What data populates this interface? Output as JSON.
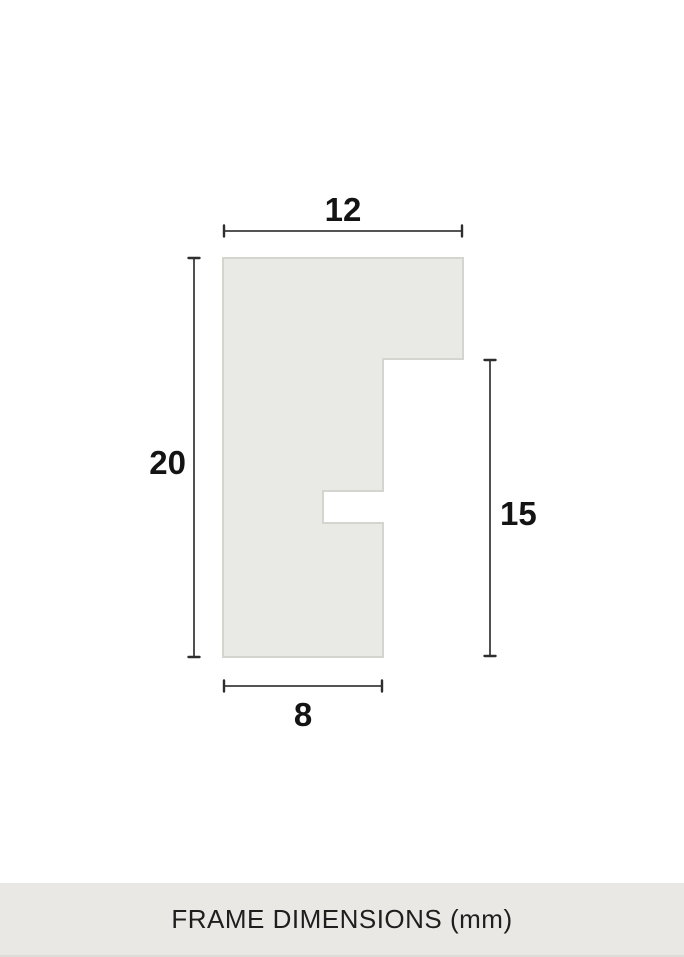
{
  "diagram": {
    "unit": "mm",
    "profile": {
      "description": "frame moulding cross-section profile",
      "points": "223,258 463,258 463,359 383,359 383,491 323,491 323,523 383,523 383,657 223,657",
      "fill": "#e9e9e5",
      "stroke": "#d5d5d0"
    },
    "measurements": {
      "top_width": {
        "value": "12"
      },
      "left_height": {
        "value": "20"
      },
      "right_height": {
        "value": "15"
      },
      "bottom_width": {
        "value": "8"
      }
    },
    "line_color": "#3c3c3c",
    "label_color": "#141414",
    "background": "#ffffff"
  },
  "footer": {
    "label": "FRAME DIMENSIONS (mm)",
    "background": "#e9e8e4",
    "text_color": "#1e1e1e"
  }
}
